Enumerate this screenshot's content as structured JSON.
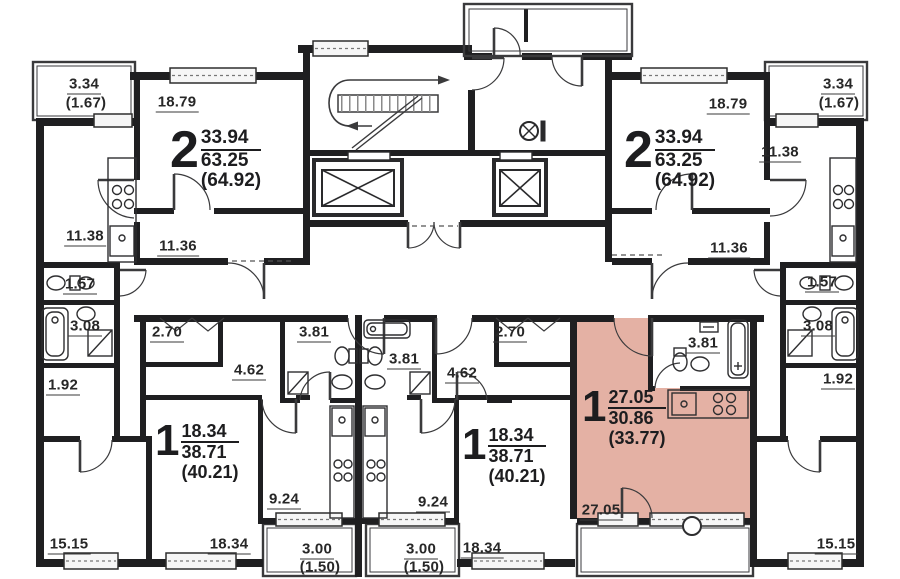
{
  "title": "Floor plan",
  "colors": {
    "highlight": "#e4b1a4",
    "wall": "#1f1f21",
    "line": "#3a3a3c",
    "text": "#272727",
    "window_fill": "#f6f6f6"
  },
  "apartments": [
    {
      "id": "two-room-left",
      "rooms": "2",
      "living": "33.94",
      "total": "63.25",
      "with_balcony": "(64.92)"
    },
    {
      "id": "two-room-right",
      "rooms": "2",
      "living": "33.94",
      "total": "63.25",
      "with_balcony": "(64.92)"
    },
    {
      "id": "one-room-left",
      "rooms": "1",
      "living": "18.34",
      "total": "38.71",
      "with_balcony": "(40.21)"
    },
    {
      "id": "one-room-right",
      "rooms": "1",
      "living": "18.34",
      "total": "38.71",
      "with_balcony": "(40.21)"
    },
    {
      "id": "studio-highlighted",
      "rooms": "1",
      "living": "27.05",
      "total": "30.86",
      "with_balcony": "(33.77)",
      "highlighted": true
    }
  ],
  "room_labels": [
    {
      "label": "3.34"
    },
    {
      "label": "(1.67)"
    },
    {
      "label": "18.79"
    },
    {
      "label": "11.38"
    },
    {
      "label": "11.36"
    },
    {
      "label": "1.57"
    },
    {
      "label": "3.08"
    },
    {
      "label": "1.92"
    },
    {
      "label": "15.15"
    },
    {
      "label": "2.70"
    },
    {
      "label": "3.81"
    },
    {
      "label": "4.62"
    },
    {
      "label": "3.81"
    },
    {
      "label": "2.70"
    },
    {
      "label": "4.62"
    },
    {
      "label": "9.24"
    },
    {
      "label": "9.24"
    },
    {
      "label": "18.34"
    },
    {
      "label": "18.34"
    },
    {
      "label": "3.00"
    },
    {
      "label": "(1.50)"
    },
    {
      "label": "3.00"
    },
    {
      "label": "(1.50)"
    },
    {
      "label": "27.05"
    },
    {
      "label": "3.81"
    },
    {
      "label": "18.79"
    },
    {
      "label": "3.34"
    },
    {
      "label": "(1.67)"
    },
    {
      "label": "11.38"
    },
    {
      "label": "11.36"
    },
    {
      "label": "1.57"
    },
    {
      "label": "3.08"
    },
    {
      "label": "1.92"
    },
    {
      "label": "15.15"
    }
  ]
}
